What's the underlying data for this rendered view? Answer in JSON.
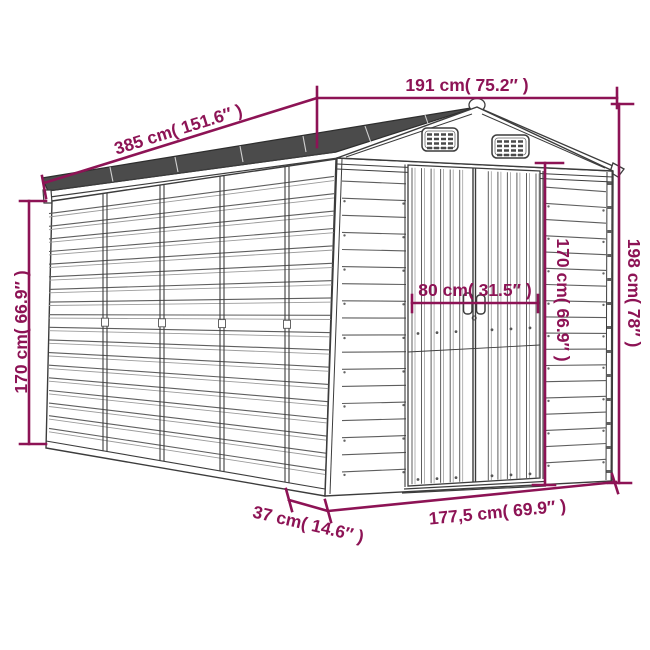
{
  "diagram": {
    "subject": "garden-shed-dimension-diagram",
    "colors": {
      "dimension_lines": "#8D1355",
      "line_art": "#3C3C3C",
      "roof_fill": "#4B4B4B",
      "background": "#FFFFFF"
    },
    "dimensions": {
      "roof_front_width": "191 cm( 75.2″ )",
      "roof_length": "385 cm( 151.6″ )",
      "side_wall_height": "170 cm( 66.9″ )",
      "door_width": "80 cm( 31.5″ )",
      "door_height": "170 cm( 66.9″ )",
      "total_height": "198 cm( 78″ )",
      "base_side_offset": "37 cm( 14.6″ )",
      "base_front_width": "177,5 cm( 69.9″ )"
    }
  }
}
